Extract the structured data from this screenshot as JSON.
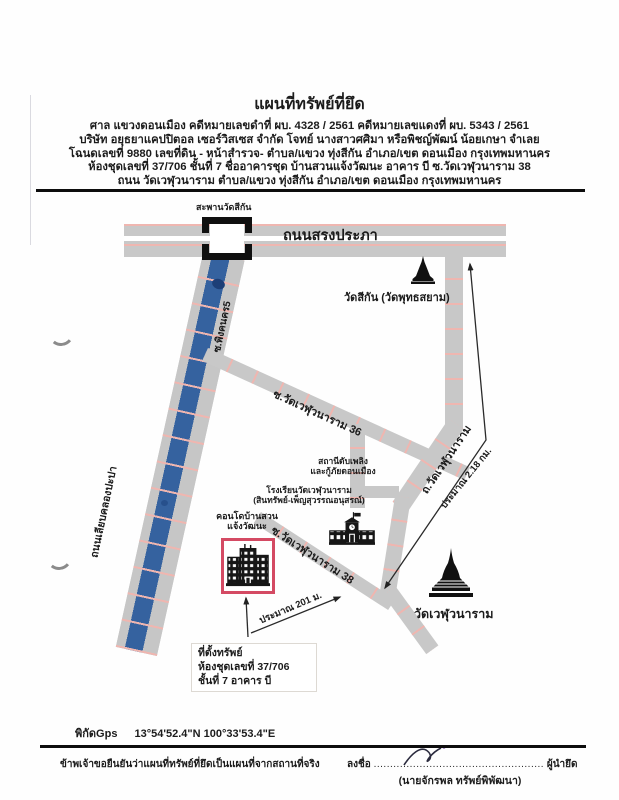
{
  "document": {
    "title": "แผนที่ทรัพย์ที่ยึด",
    "header_lines": [
      "ศาล แขวงดอนเมือง   คดีหมายเลขดำที่ ผบ. 4328 / 2561     คดีหมายเลขแดงที่ ผบ. 5343 / 2561",
      "บริษัท อยุธยาแคปปิตอล เซอร์วิสเซส จำกัด   โจทย์          นางสาวศศิมา หรือพิชญ์พัฒน์ น้อยเกษา   จำเลย",
      "โฉนดเลขที่ 9880 เลขที่ดิน - หน้าสำรวจ- ตำบล/แขวง ทุ่งสีกัน  อำเภอ/เขต ดอนเมือง   กรุงเทพมหานคร",
      "ห้องชุดเลขที่ 37/706  ชั้นที่ 7 ชื่ออาคารชุด บ้านสวนแจ้งวัฒนะ อาคาร บี  ซ.วัดเวฬุวนาราม 38",
      "ถนน วัดเวฬุวนาราม  ตำบล/แขวง ทุ่งสีกัน  อำเภอ/เขต ดอนเมือง   กรุงเทพมหานคร"
    ]
  },
  "map": {
    "bridge_label": "สะพานวัดสีกัน",
    "road_songprapha": "ถนนสรงประภา",
    "soi_phingkhonkhon": "ซ.พิงคนคร5",
    "road_liab_khlong": "ถนนเลียบคลองปะปา",
    "soi_36": "ซ.วัดเวฬุวนาราม 36",
    "road_wat_weluwanaram": "ถ.วัดเวฬุวนาราม",
    "soi_38": "ซ.วัดเวฬุวนาราม 38",
    "wat_sikan": "วัดสีกัน (วัดพุทธสยาม)",
    "wat_weluwanaram": "วัดเวฬุวนาราม",
    "fire_station_line1": "สถานีดับเพลิง",
    "fire_station_line2": "และกู้ภัยดอนเมือง",
    "school_line1": "โรงเรียนวัดเวฬุวนาราม",
    "school_line2": "(สินทรัพย์-เพ็ญสุวรรณอนุสรณ์)",
    "condo_line1": "คอนโดบ้านสวน",
    "condo_line2": "แจ้งวัฒนะ",
    "distance_2_18_km": "ประมาณ 2.18 กม.",
    "distance_201_m": "ประมาณ 201 ม.",
    "property_box_line1": "ที่ตั้งทรัพย์",
    "property_box_line2": "ห้องชุดเลขที่ 37/706",
    "property_box_line3": "ชั้นที่ 7 อาคาร บี",
    "icons": {
      "wat_sikan": "stupa-icon",
      "wat_weluwanaram": "stupa-icon",
      "school": "school-building-icon",
      "condo": "condo-building-icon",
      "bridge": "bridge-icon"
    }
  },
  "footer": {
    "gps_label": "พิกัดGps",
    "gps_value": "13°54'52.4\"N 100°33'53.4\"E",
    "certify_text": "ข้าพเจ้าขอยืนยันว่าแผนที่ทรัพย์ที่ยึดเป็นแผนที่จากสถานที่จริง",
    "sign_label": "ลงชื่อ",
    "sign_dots": "....................................................",
    "sign_role": "ผู้นำยึด",
    "signer_name": "(นายจักรพล  ทรัพย์พิพัฒนา)"
  },
  "colors": {
    "road_gray": "#c8c8c8",
    "lane_pink": "#efb6b0",
    "canal_blue": "#35629f",
    "property_red": "#d44a63",
    "ink": "#1b1b1b"
  }
}
